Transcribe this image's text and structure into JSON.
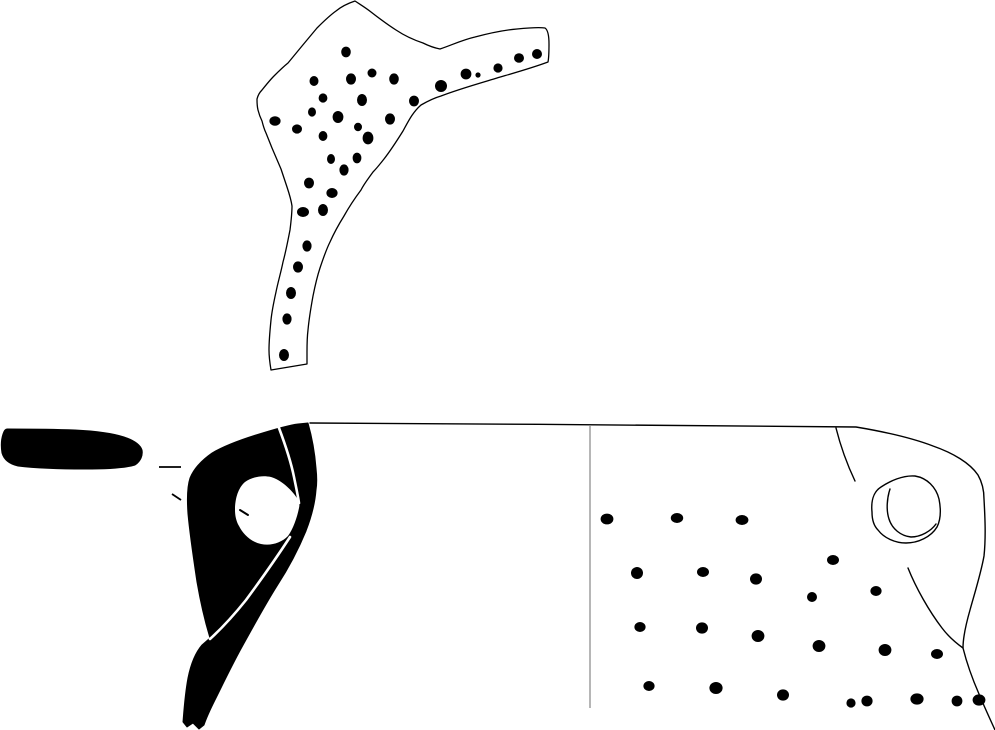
{
  "figure": {
    "paper_color": "#ffffff",
    "ink_color": "#000000",
    "divider_color": "#8f8f8f"
  },
  "upper_sherd": {
    "outline_path": "M 355,1 C 361,5 366,8 371,12 C 380,19 388,25 396,30 C 405,36 414,40 423,43 C 429,46 435,48 440,49 C 452,45 462,40 475,37 C 490,33 505,30 517,29 C 527,28 538,27 545,28 C 548,30 549,36 549,44 C 549,50 549,57 548,62 C 532,68 514,73 497,78 C 477,84 456,90 441,96 C 434,98 428,101 421,105 C 413,112 409,120 403,131 C 398,139 391,150 384,159 C 380,164 377,168 373,172 C 368,179 364,184 361,190 C 355,198 349,207 344,216 C 339,224 334,233 330,242 C 326,250 323,259 320,268 C 317,277 315,286 313,296 C 311,307 309,319 308,330 C 307,338 307,345 307,352 L 307,364 L 271,370 C 270,364 269,357 269,350 C 269,340 270,330 271,320 C 272,310 274,301 276,292 C 278,282 281,272 283,262 C 286,251 288,240 290,230 C 291,222 292,213 292,206 C 291,199 289,193 287,187 C 285,181 283,175 281,169 C 278,162 275,155 272,148 C 270,143 268,138 266,133 C 264,129 263,125 262,121 C 260,117 259,114 258,110 C 257,106 257,103 257,99 C 258,95 260,92 262,90 C 266,85 270,80 274,76 C 279,71 283,67 288,63 C 293,57 297,52 302,46 C 307,40 312,34 317,28 C 323,22 329,16 336,11 C 342,6 349,3 355,1 Z",
    "dots": [
      [
        346,
        52,
        4.8,
        5.4
      ],
      [
        314,
        81,
        4.5,
        5
      ],
      [
        351,
        79,
        5,
        5.6
      ],
      [
        372,
        73,
        4.5,
        4.5
      ],
      [
        394,
        79,
        4.8,
        5.6
      ],
      [
        323,
        98,
        4.4,
        4.6
      ],
      [
        362,
        100,
        5,
        6
      ],
      [
        414,
        101,
        5,
        5.4
      ],
      [
        312,
        112,
        4,
        4.6
      ],
      [
        338,
        117,
        5.4,
        6
      ],
      [
        275,
        121,
        5.6,
        4.8
      ],
      [
        297,
        129,
        5,
        4.6
      ],
      [
        390,
        119,
        5,
        5.6
      ],
      [
        358,
        127,
        4,
        4.2
      ],
      [
        323,
        136,
        4.4,
        5
      ],
      [
        368,
        138,
        5.4,
        6.4
      ],
      [
        331,
        159,
        4,
        5
      ],
      [
        357,
        158,
        4.4,
        5.4
      ],
      [
        344,
        170,
        4.6,
        5.6
      ],
      [
        441,
        86,
        6,
        6
      ],
      [
        466,
        74,
        5.4,
        5.4
      ],
      [
        478,
        75,
        2.6,
        2.6
      ],
      [
        498,
        68,
        4.6,
        4.6
      ],
      [
        519,
        58,
        5,
        4.8
      ],
      [
        537,
        54,
        5,
        5
      ],
      [
        309,
        183,
        5,
        5.4
      ],
      [
        332,
        193,
        5.6,
        5
      ],
      [
        303,
        212,
        6,
        5
      ],
      [
        323,
        210,
        5,
        6
      ],
      [
        307,
        246,
        4.6,
        5.6
      ],
      [
        298,
        267,
        5,
        5.6
      ],
      [
        291,
        293,
        5,
        6
      ],
      [
        287,
        319,
        4.6,
        5.6
      ],
      [
        284,
        355,
        5,
        6
      ]
    ]
  },
  "rim_section": {
    "path": "M 7,429 C 25,429 50,429 75,430 C 95,431 112,433 124,437 C 133,440 140,444 142,450 C 143,455 141,461 135,465 C 125,468 105,469 85,469 C 62,469 35,468 18,466 C 9,464 4,460 2,453 C 1,447 1,440 3,434 C 4,431 5,429 7,429 Z"
  },
  "leader_marks": {
    "dash_upper": "M 159,467 L 181,467",
    "dash_lower": "M 172,494 L 181,500"
  },
  "handle_section": {
    "body_path": "M 308,423 C 312,437 315,455 316,468 C 317,477 317,484 316,490 C 315,504 311,518 306,531 C 299,548 288,569 277,586 C 265,605 252,629 242,647 C 232,665 222,686 215,700 C 210,710 206,719 204,725 L 199,729 L 193,723 L 187,727 L 183,722 C 184,709 185,694 188,678 C 191,663 196,652 202,645 L 210,638 C 206,625 201,605 197,582 C 194,562 190,536 188,514 C 187,500 187,487 190,478 C 194,468 202,460 212,453 C 224,446 240,440 256,435 C 272,430 289,425 298,424 Z",
    "hole_path": "M 235,510 C 235,499 238,488 245,482 C 252,477 262,475 271,477 C 281,480 291,489 297,498 C 299,501 300,504 299,508 C 297,518 293,529 288,536 C 281,543 271,546 261,544 C 251,542 243,534 239,526 C 236,521 235,515 235,510 Z",
    "seam_top": "M 279,428 C 285,444 291,462 294,477 C 296,487 298,496 299,503",
    "seam_bottom": "M 290,537 C 277,557 260,581 246,600 C 234,615 221,629 210,639",
    "hole_tick": "M 240,510 L 248,515"
  },
  "body_profile": {
    "outline_path": "M 310,423 C 490,424 680,425 856,427 C 886,432 912,438 933,446 C 953,453 970,463 978,475 C 982,482 984,491 984,499 C 985,517 986,537 984,556 C 981,573 975,592 970,610 C 966,624 963,638 963,648 C 966,660 972,678 979,694 C 984,706 990,719 995,730",
    "divider_line": "M 590,426 L 590,708",
    "rim_curve": "M 836,428 C 840,444 846,462 855,481",
    "inner_curve": "M 908,568 C 916,588 929,611 942,628 C 948,636 956,643 963,648",
    "hole_outer": "M 872,512 C 871,502 873,492 881,487 C 890,481 903,475 915,476 C 927,478 936,487 939,499 C 941,509 941,519 937,527 C 931,537 918,543 906,543 C 895,543 884,538 878,530 C 873,525 872,518 872,512 Z",
    "hole_inner": "M 890,489 C 887,498 886,510 889,519 C 892,529 901,536 911,537 C 921,537 931,531 936,524",
    "dots": [
      [
        607,
        519,
        6.4,
        5.4
      ],
      [
        677,
        518,
        6.2,
        5
      ],
      [
        742,
        520,
        6.4,
        5
      ],
      [
        637,
        573,
        6,
        6
      ],
      [
        703,
        572,
        6,
        5
      ],
      [
        756,
        579,
        6,
        5.6
      ],
      [
        833,
        560,
        6,
        5
      ],
      [
        876,
        591,
        5.6,
        5
      ],
      [
        812,
        597,
        5,
        5
      ],
      [
        640,
        627,
        5.6,
        5
      ],
      [
        702,
        628,
        6,
        5.6
      ],
      [
        758,
        636,
        6.4,
        6
      ],
      [
        819,
        646,
        6.4,
        6
      ],
      [
        885,
        650,
        6.4,
        6
      ],
      [
        937,
        654,
        6,
        5
      ],
      [
        649,
        686,
        5.6,
        5
      ],
      [
        716,
        688,
        6.6,
        6
      ],
      [
        783,
        695,
        6,
        5.6
      ],
      [
        851,
        703,
        4.6,
        4.6
      ],
      [
        867,
        701,
        5.6,
        5.4
      ],
      [
        917,
        699,
        6.6,
        5.6
      ],
      [
        957,
        701,
        5.4,
        5.4
      ],
      [
        979,
        700,
        6.4,
        5.6
      ]
    ]
  }
}
